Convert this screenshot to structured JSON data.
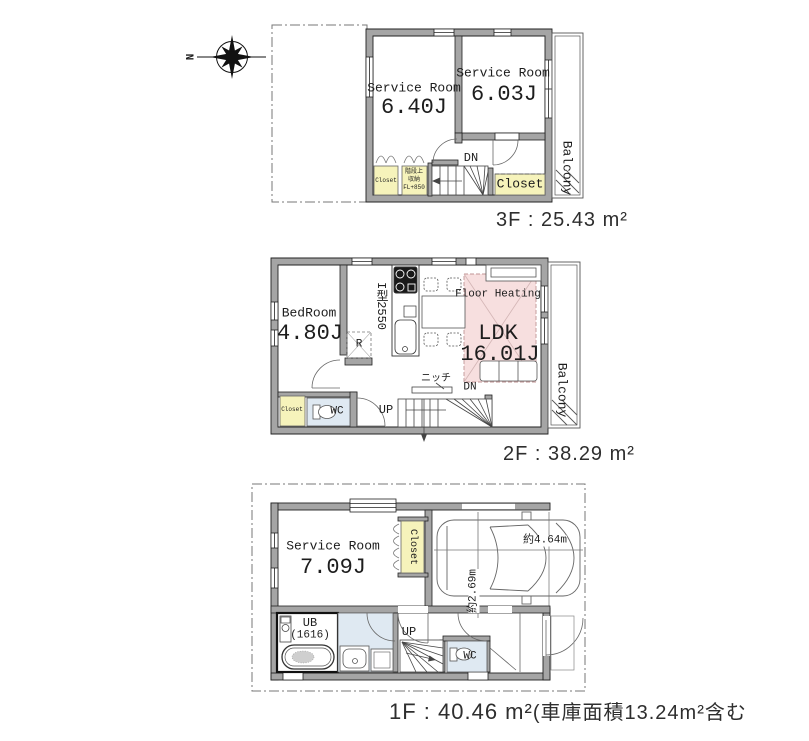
{
  "compass": {
    "north": "N"
  },
  "colors": {
    "wall_gray": "#a5a5a5",
    "closet_yellow": "#f6f3bb",
    "heating_pink": "#f7dfdf",
    "wet_area_blue": "#dfe9f2"
  },
  "f3": {
    "room_a_name": "Service Room",
    "room_a_size": "6.40J",
    "room_b_name": "Service Room",
    "room_b_size": "6.03J",
    "balcony": "Balcony",
    "closet_a": "Closet",
    "storage_1": "階段上",
    "storage_2": "収納",
    "storage_3": "FL+850",
    "dn": "DN",
    "closet_b": "Closet",
    "area": "3F : 25.43 m²"
  },
  "f2": {
    "bedroom_name": "BedRoom",
    "bedroom_size": "4.80J",
    "kitchen": "I型2550",
    "fridge": "R",
    "heating": "Floor Heating",
    "ldk_name": "LDK",
    "ldk_size": "16.01J",
    "niche": "ニッチ",
    "dn": "DN",
    "up": "UP",
    "wc": "WC",
    "closet": "Closet",
    "balcony": "Balcony",
    "area": "2F : 38.29 m²"
  },
  "f1": {
    "room_name": "Service Room",
    "room_size": "7.09J",
    "closet": "Closet",
    "garage_width": "約4.64m",
    "garage_depth": "約2.69m",
    "ub_name": "UB",
    "ub_size": "(1616)",
    "up": "UP",
    "wc": "WC",
    "area_main": "1F : 40.46 m²",
    "area_note": "(車庫面積13.24m²含む"
  }
}
